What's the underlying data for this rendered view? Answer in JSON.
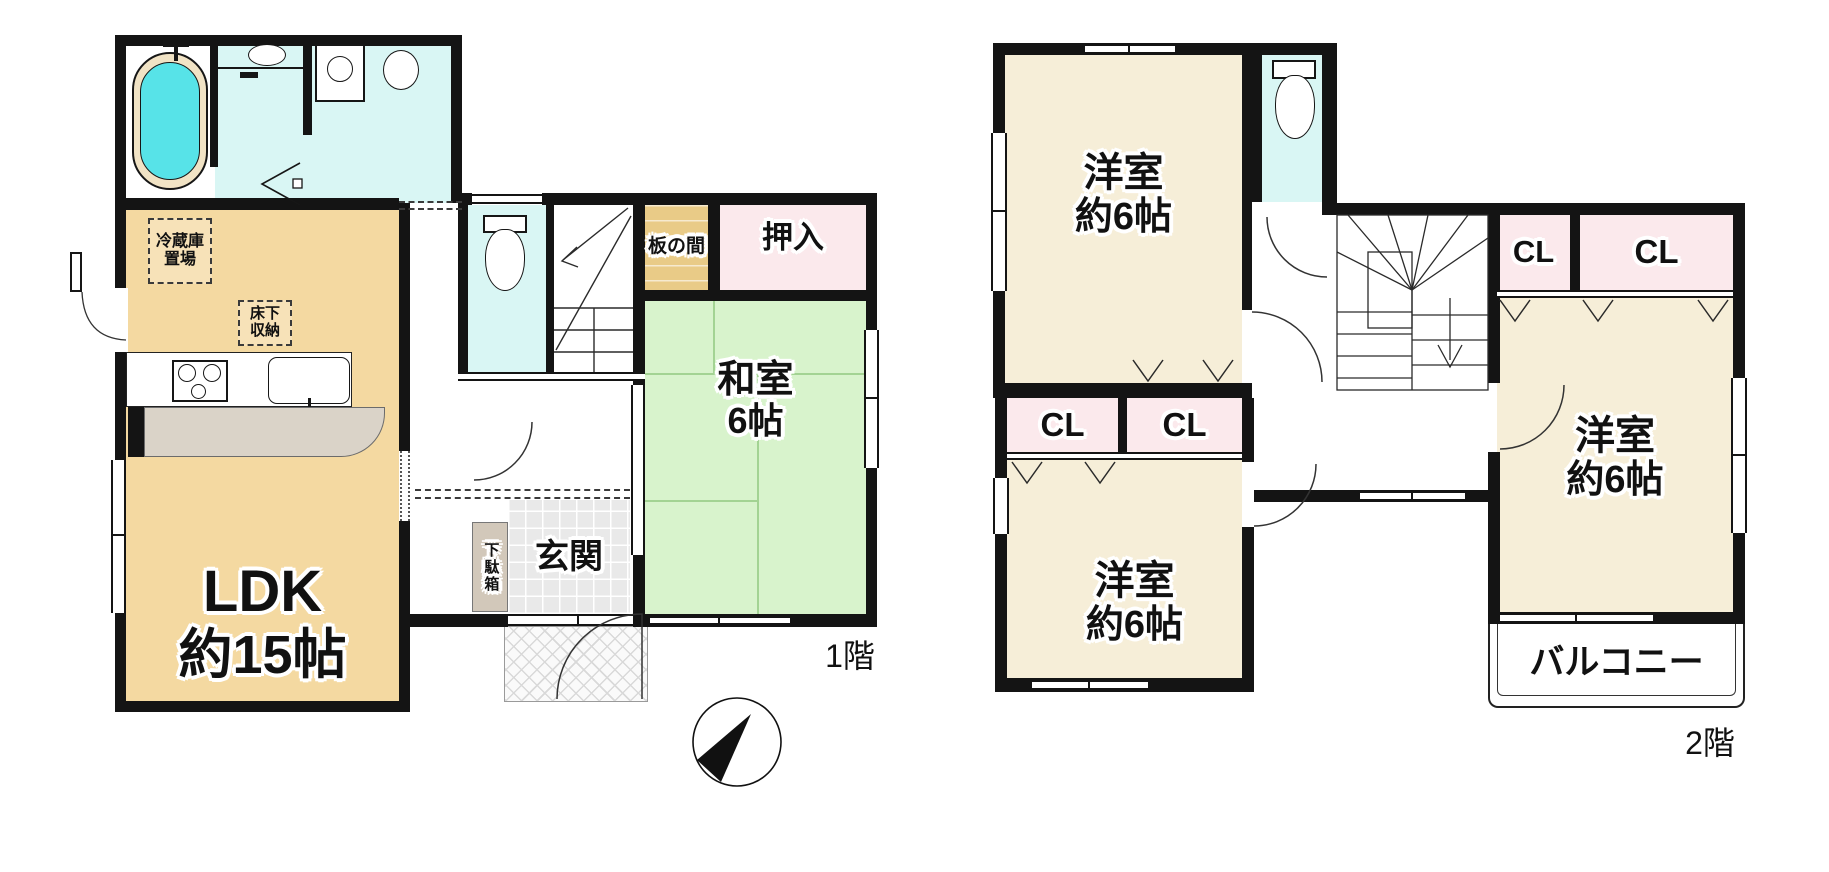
{
  "title": "間取り図",
  "colors": {
    "wall": "#141414",
    "ldk_fill": "#F4D9A1",
    "tatami_fill": "#D8F3CC",
    "tatami_line": "#A3D393",
    "closet_pink": "#FBE9EC",
    "wet_area_cyan": "#D9F6F4",
    "western_cream": "#F6EED8",
    "bathtub_water": "#57E3E8",
    "bathtub_rim": "#F1E3C5",
    "itanoma_fill": "#E9CB87",
    "counter_gray": "#DAD3C8",
    "getabako_fill": "#D2C8BA"
  },
  "floor1": {
    "floor_label": "1階",
    "rooms": {
      "ldk": {
        "name": "LDK",
        "size": "約15帖"
      },
      "washitsu": {
        "name": "和室",
        "size": "6帖"
      },
      "genkan": {
        "name": "玄関"
      },
      "getabako": {
        "name": "下駄箱"
      },
      "oshiire": {
        "name": "押入"
      },
      "itanoma": {
        "name": "板の間"
      },
      "reizoko": {
        "line1": "冷蔵庫",
        "line2": "置場"
      },
      "yukashita": {
        "line1": "床下",
        "line2": "収納"
      }
    }
  },
  "floor2": {
    "floor_label": "2階",
    "rooms": {
      "youshitsu1": {
        "name": "洋室",
        "size": "約6帖"
      },
      "youshitsu2": {
        "name": "洋室",
        "size": "約6帖"
      },
      "youshitsu3": {
        "name": "洋室",
        "size": "約6帖"
      },
      "cl_a": {
        "label": "CL"
      },
      "cl_b": {
        "label": "CL"
      },
      "cl_c": {
        "label": "CL"
      },
      "cl_d": {
        "label": "CL"
      },
      "balcony": {
        "name": "バルコニー"
      }
    }
  },
  "compass": {
    "north_label": "N"
  }
}
